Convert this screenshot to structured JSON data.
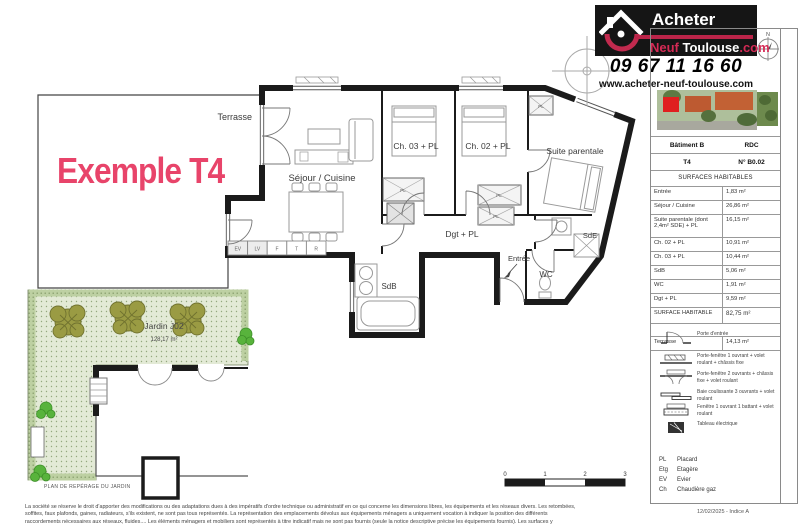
{
  "colors": {
    "accent_pink": "#e8446a",
    "logo_red": "#c12a4e",
    "logo_black": "#151515",
    "wall_black": "#1b1b1b",
    "garden_green": "#e3ead6",
    "hedge_green": "#bdd0a2",
    "tree_olive": "#9a9b43",
    "bush_green": "#58b33c"
  },
  "header": {
    "logo": {
      "line1": "Acheter",
      "line2_red": "Neuf",
      "line2_black": "Toulouse",
      "line2_suffix": ".com"
    },
    "phone": "09 67 11 16 60",
    "website": "www.acheter-neuf-toulouse.com"
  },
  "example_label": "Exemple T4",
  "plan": {
    "rooms": {
      "terrasse": "Terrasse",
      "sejour": "Séjour / Cuisine",
      "ch03": "Ch. 03 + PL",
      "ch02": "Ch. 02 + PL",
      "suite": "Suite parentale",
      "dgt": "Dgt + PL",
      "sde": "SdE",
      "entree": "Entrée",
      "wc": "WC",
      "sdb": "SdB"
    },
    "kitchen_units": [
      "EV",
      "LV",
      "F",
      "T",
      "R"
    ],
    "closet_label": "PL",
    "garden": {
      "name": "Jardin J02",
      "area": "128,17 m²"
    },
    "north_label": "N",
    "scale_ticks": [
      "0",
      "1",
      "2",
      "3"
    ],
    "reperage_label": "PLAN DE REPÉRAGE DU JARDIN"
  },
  "sidebar": {
    "building": "Bâtiment B",
    "floor": "RDC",
    "type": "T4",
    "lot": "N° B0.02",
    "section_title": "SURFACES HABITABLES",
    "rows": [
      {
        "label": "Entrée",
        "value": "1,83 m²"
      },
      {
        "label": "Séjour / Cuisine",
        "value": "26,86 m²"
      },
      {
        "label": "Suite parentale (dont 2,4m² SDE) + PL",
        "value": "16,15 m²"
      },
      {
        "label": "Ch. 02 + PL",
        "value": "10,91 m²"
      },
      {
        "label": "Ch. 03 + PL",
        "value": "10,44 m²"
      },
      {
        "label": "SdB",
        "value": "5,06 m²"
      },
      {
        "label": "WC",
        "value": "1,91 m²"
      },
      {
        "label": "Dgt + PL",
        "value": "9,59 m²"
      }
    ],
    "total": {
      "label": "SURFACE HABITABLE",
      "value": "82,75 m²"
    },
    "terrasse_row": {
      "label": "Terrasse",
      "value": "14,13 m²"
    },
    "window_legend": [
      "Porte d'entrée",
      "Porte-fenêtre 1 ouvrant + volet roulant + châssis fixe",
      "Porte-fenêtre 2 ouvrants + châssis fixe + volet roulant",
      "Baie coulissante 3 ouvrants + volet roulant",
      "Fenêtre 1 ouvrant 1 battant + volet roulant",
      "Tableau électrique"
    ],
    "abbreviations": [
      {
        "abbr": "PL",
        "label": "Placard"
      },
      {
        "abbr": "Etg",
        "label": "Etagère"
      },
      {
        "abbr": "EV",
        "label": "Evier"
      },
      {
        "abbr": "Ch",
        "label": "Chaudière gaz"
      }
    ],
    "revision": "12/02/2025  - Indice A"
  },
  "footer": {
    "disclaimer_lines": [
      "La société se réserve le droit d'apporter des modifications ou des adaptations dues à des impératifs d'ordre technique ou administratif en ce qui concerne les dimensions libres, les équipements et les réseaux divers. Les retombées,",
      "soffites, faux plafonds, gaines, radiateurs, s'ils existent, ne sont pas tous représentés. La représentation des emplacements dévolus aux équipements ménagers a uniquement vocation à indiquer la position des différents",
      "raccordements nécessaires aux réseaux, fluides.... Les éléments ménagers et mobiliers sont représentés à titre indicatif mais ne sont pas fournis (seule la notice descriptive précise les équipements fournis). Les surfaces y"
    ]
  }
}
